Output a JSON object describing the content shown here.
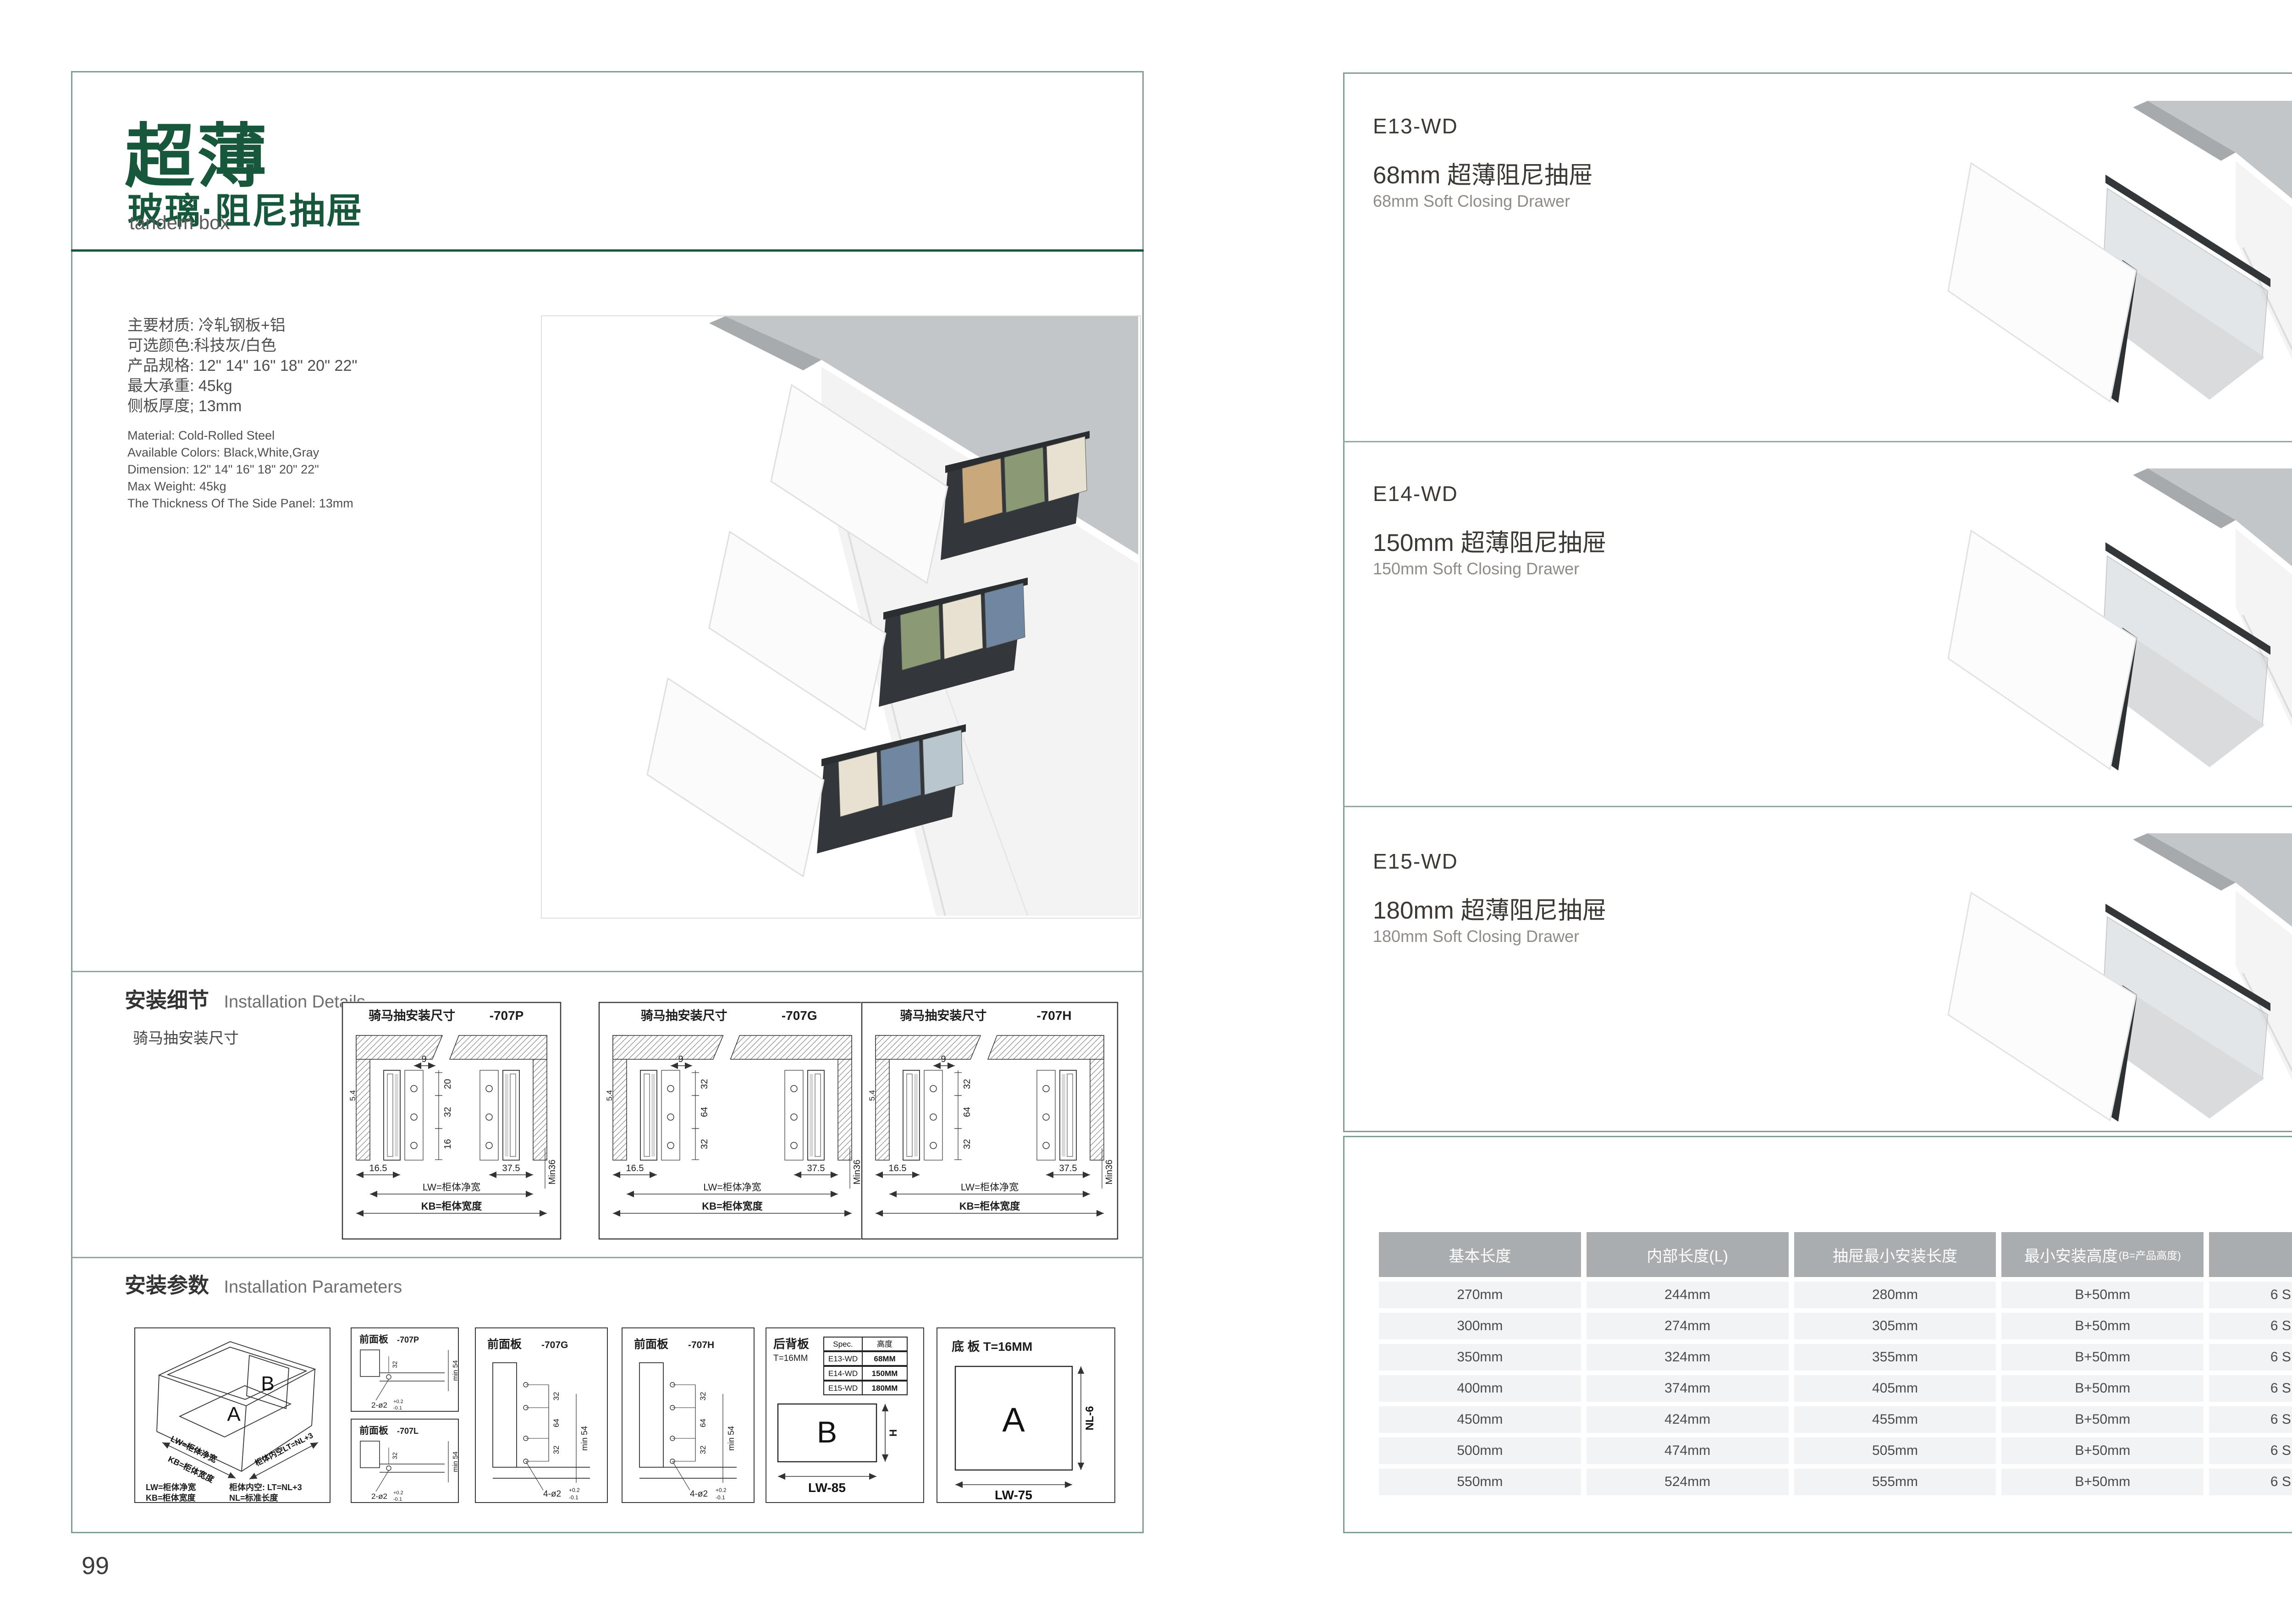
{
  "colors": {
    "accent_green": "#17573C",
    "frame_green_gray": "#7FA090",
    "table_header_bg": "#A9ADB0",
    "table_row_bg": "#F2F3F4"
  },
  "left": {
    "title_cn": "超薄",
    "subtitle_cn": "玻璃·阻尼抽屉",
    "subtitle_en": "tandem box",
    "specs_cn": [
      "主要材质: 冷轧钢板+铝",
      "可选颜色:科技灰/白色",
      "产品规格: 12\" 14\" 16\" 18\" 20\" 22\"",
      "最大承重: 45kg",
      "侧板厚度; 13mm"
    ],
    "specs_en": [
      "Material: Cold-Rolled Steel",
      "Available Colors: Black,White,Gray",
      "Dimension: 12\" 14\" 16\" 18\" 20\" 22\"",
      "Max Weight: 45kg",
      "The Thickness Of The Side Panel: 13mm"
    ],
    "details": {
      "heading_cn": "安装细节",
      "heading_en": "Installation Details",
      "subheading": "骑马抽安装尺寸",
      "drawings": [
        {
          "title": "骑马抽安装尺寸",
          "code": "-707P",
          "top_dim": "9",
          "chain": [
            "20",
            "32",
            "16"
          ],
          "side_dim": "5.4",
          "bottom_left": "16.5",
          "bottom_right": "37.5",
          "lw": "LW=柜体净宽",
          "kb": "KB=柜体宽度",
          "min": "Min36"
        },
        {
          "title": "骑马抽安装尺寸",
          "code": "-707G",
          "top_dim": "9",
          "chain": [
            "32",
            "64",
            "32"
          ],
          "side_dim": "5.4",
          "bottom_left": "16.5",
          "bottom_right": "37.5",
          "lw": "LW=柜体净宽",
          "kb": "KB=柜体宽度",
          "min": "Min36"
        },
        {
          "title": "骑马抽安装尺寸",
          "code": "-707H",
          "top_dim": "9",
          "chain": [
            "32",
            "64",
            "32"
          ],
          "side_dim": "5.4",
          "bottom_left": "16.5",
          "bottom_right": "37.5",
          "lw": "LW=柜体净宽",
          "kb": "KB=柜体宽度",
          "min": "Min36"
        }
      ]
    },
    "params": {
      "heading_cn": "安装参数",
      "heading_en": "Installation Parameters",
      "iso": {
        "a": "A",
        "b": "B",
        "lw": "LW=柜体净宽",
        "kb": "KB=柜体宽度",
        "lt": "柜体内空LT=NL+3",
        "legend": [
          [
            "LW=柜体净宽",
            "柜体内空: LT=NL+3"
          ],
          [
            "KB=柜体宽度",
            "NL=标准长度"
          ]
        ]
      },
      "front_panels": [
        {
          "title": "前面板",
          "code": "-707P",
          "holes": 2,
          "min": "min 54",
          "dims": [
            "32"
          ],
          "leader": "2-ø2",
          "tol_up": "+0.2",
          "tol_dn": "-0.1"
        },
        {
          "title": "前面板",
          "code": "-707L",
          "holes": 2,
          "min": "min 54",
          "dims": [
            "32"
          ],
          "leader": "2-ø2",
          "tol_up": "+0.2",
          "tol_dn": "-0.1"
        },
        {
          "title": "前面板",
          "code": "-707G",
          "holes": 4,
          "min": "min 54",
          "dims": [
            "32",
            "64",
            "32"
          ],
          "leader": "4-ø2",
          "tol_up": "+0.2",
          "tol_dn": "-0.1"
        },
        {
          "title": "前面板",
          "code": "-707H",
          "holes": 4,
          "min": "min 54",
          "dims": [
            "32",
            "64",
            "32"
          ],
          "leader": "4-ø2",
          "tol_up": "+0.2",
          "tol_dn": "-0.1"
        }
      ],
      "back_panel": {
        "title": "后背板",
        "thickness": "T=16MM",
        "spec_headers": [
          "Spec.",
          "高度"
        ],
        "spec_rows": [
          [
            "E13-WD",
            "68MM"
          ],
          [
            "E14-WD",
            "150MM"
          ],
          [
            "E15-WD",
            "180MM"
          ]
        ],
        "label": "B",
        "h": "H",
        "w": "LW-85"
      },
      "bottom_panel": {
        "title": "底 板 T=16MM",
        "label": "A",
        "h": "NL-6",
        "w": "LW-75"
      }
    },
    "page_number": "99"
  },
  "right": {
    "products": [
      {
        "code": "E13-WD",
        "name_cn": "68mm 超薄阻尼抽屉",
        "name_en": "68mm Soft Closing Drawer"
      },
      {
        "code": "E14-WD",
        "name_cn": "150mm 超薄阻尼抽屉",
        "name_en": "150mm Soft Closing Drawer"
      },
      {
        "code": "E15-WD",
        "name_cn": "180mm 超薄阻尼抽屉",
        "name_en": "180mm Soft Closing Drawer"
      }
    ],
    "table": {
      "headers": [
        "基本长度",
        "内部长度(L)",
        "抽屉最小安装长度",
        "最小安装高度",
        "包装"
      ],
      "header_note": "(B=产品高度)",
      "rows": [
        [
          "270mm",
          "244mm",
          "280mm",
          "B+50mm",
          "6 SETC/TNB"
        ],
        [
          "300mm",
          "274mm",
          "305mm",
          "B+50mm",
          "6 SETC/TNB"
        ],
        [
          "350mm",
          "324mm",
          "355mm",
          "B+50mm",
          "6 SETC/TNB"
        ],
        [
          "400mm",
          "374mm",
          "405mm",
          "B+50mm",
          "6 SETC/TNB"
        ],
        [
          "450mm",
          "424mm",
          "455mm",
          "B+50mm",
          "6 SETC/TNB"
        ],
        [
          "500mm",
          "474mm",
          "505mm",
          "B+50mm",
          "6 SETC/TNB"
        ],
        [
          "550mm",
          "524mm",
          "555mm",
          "B+50mm",
          "6 SETC/TNB"
        ]
      ]
    },
    "page_number": "100"
  }
}
